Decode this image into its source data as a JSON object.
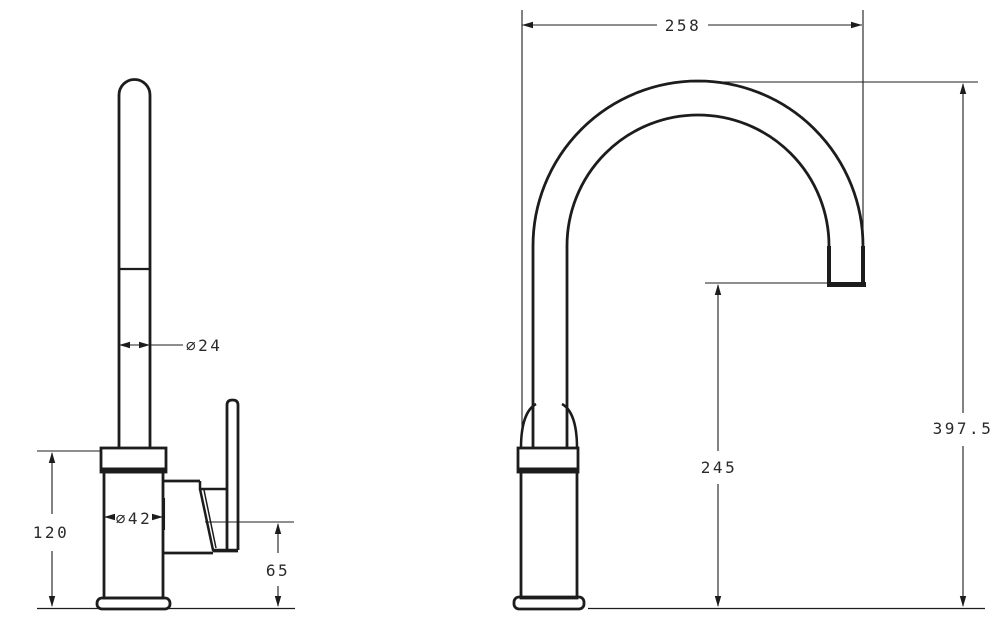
{
  "colors": {
    "line": "#1c1c1c",
    "background": "#ffffff",
    "text": "#2a2a2a"
  },
  "views": {
    "front": {
      "dims": {
        "spout_diameter": "∅24",
        "body_diameter": "∅42",
        "body_height": "120",
        "outlet_height": "65"
      }
    },
    "side": {
      "dims": {
        "spout_reach": "258",
        "overall_height": "397.5",
        "spout_height": "245"
      }
    }
  }
}
